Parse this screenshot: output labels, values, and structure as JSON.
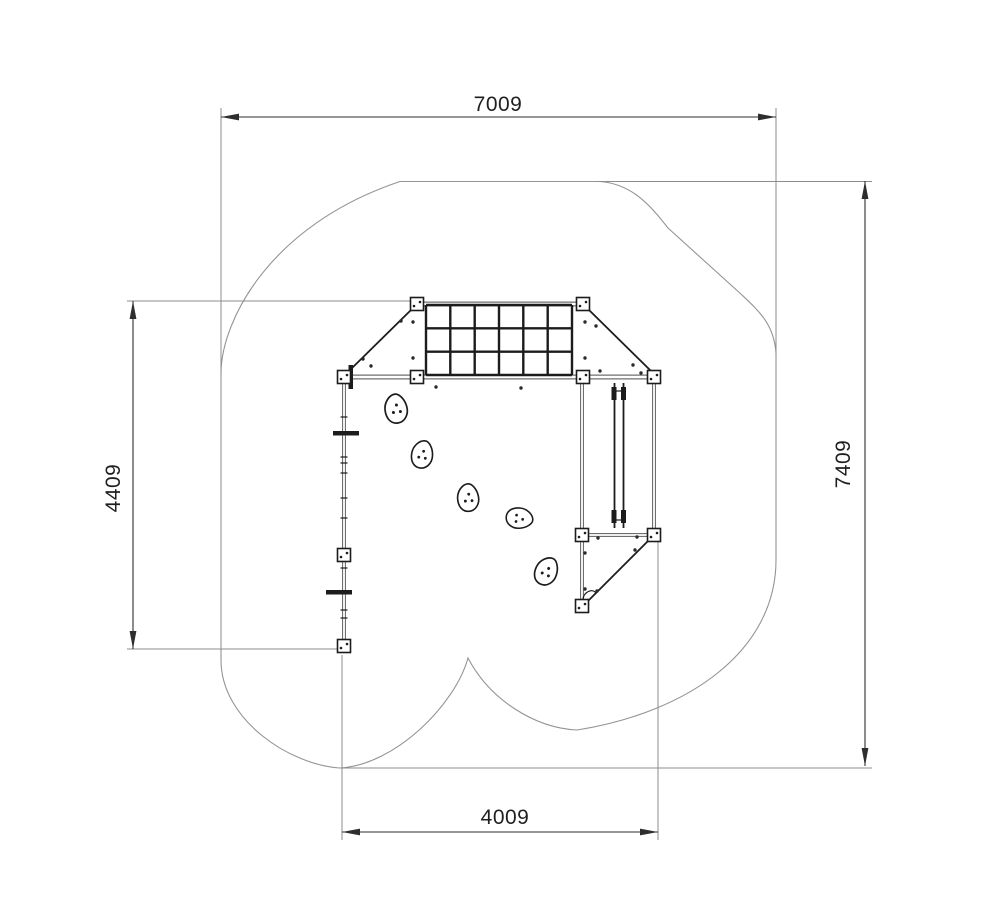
{
  "drawing": {
    "title": "playground-equipment-plan-view",
    "dimensions": {
      "top_width": {
        "value": "7009"
      },
      "right_height": {
        "value": "7409"
      },
      "left_height": {
        "value": "4409"
      },
      "bottom_width": {
        "value": "4009"
      }
    },
    "colors": {
      "background": "#ffffff",
      "dimension-line": "#2e2e2e",
      "extension-line": "#8c8c8c",
      "boundary-line": "#949494",
      "rail-gray": "#6f6f6f",
      "structure-dark": "#1c1c1c",
      "text": "#1f1f1f"
    }
  }
}
